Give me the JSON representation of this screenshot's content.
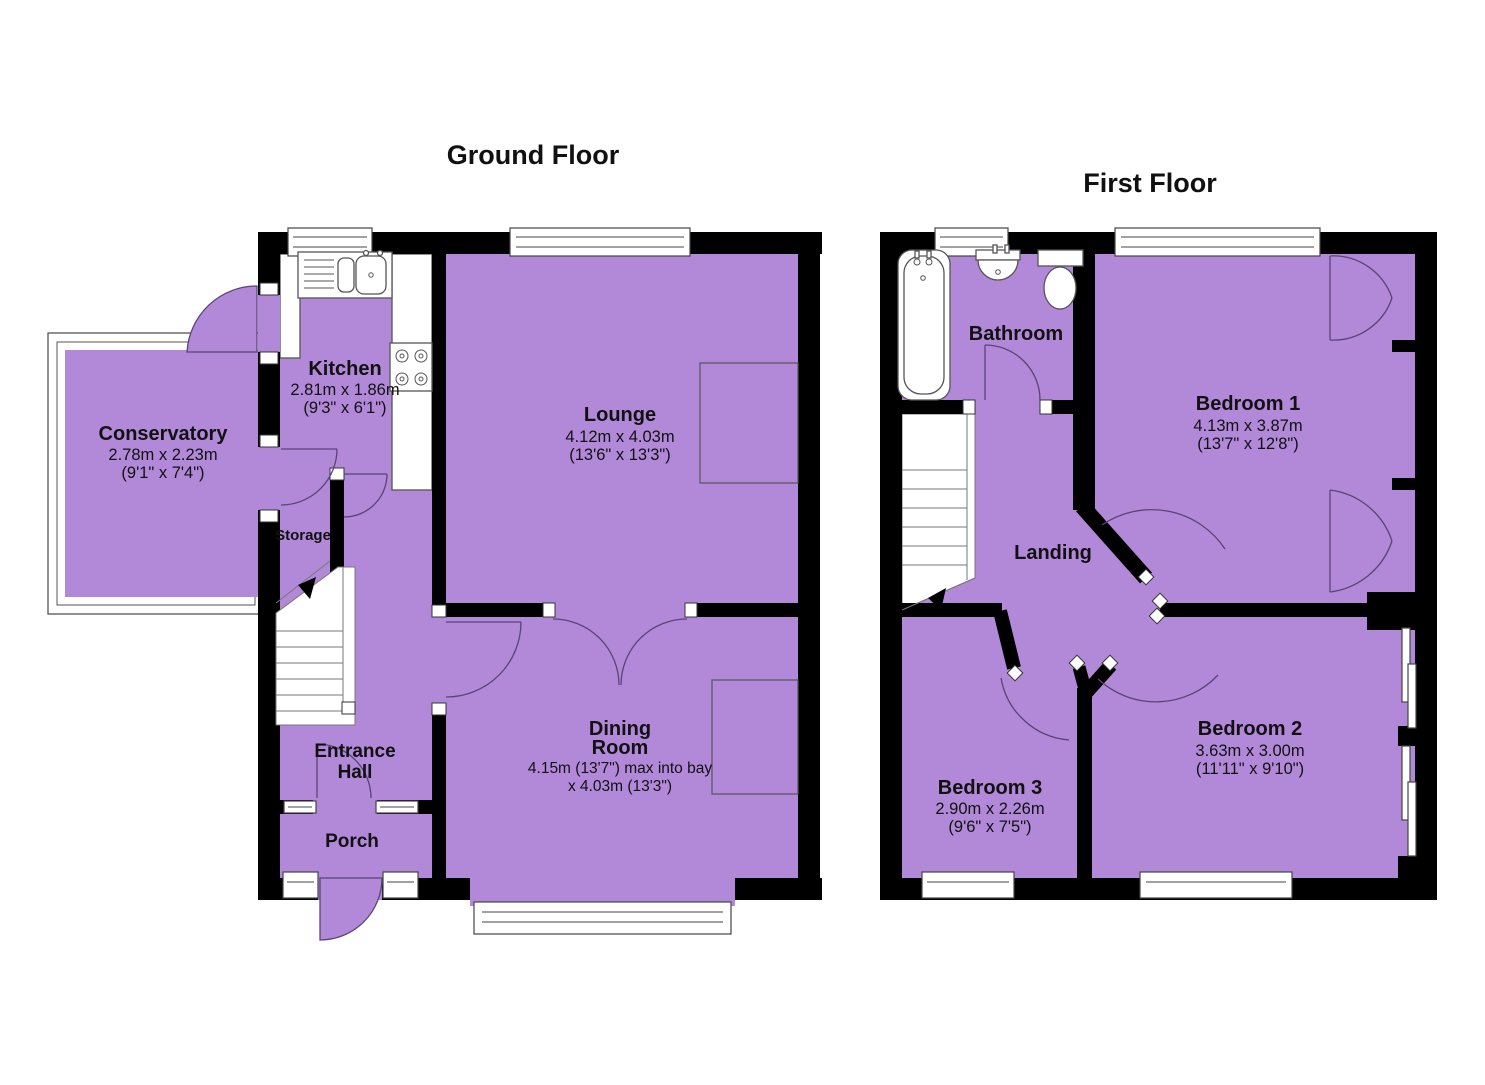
{
  "floors": [
    {
      "id": "ground-floor",
      "title": "Ground Floor",
      "rooms": [
        {
          "id": "kitchen",
          "name": "Kitchen",
          "dim_metric": "2.81m x 1.86m",
          "dim_imperial": "(9'3\" x 6'1\")"
        },
        {
          "id": "lounge",
          "name": "Lounge",
          "dim_metric": "4.12m x 4.03m",
          "dim_imperial": "(13'6\" x 13'3\")"
        },
        {
          "id": "conservatory",
          "name": "Conservatory",
          "dim_metric": "2.78m x 2.23m",
          "dim_imperial": "(9'1\" x 7'4\")"
        },
        {
          "id": "storage",
          "name": "Storage"
        },
        {
          "id": "entrance-hall",
          "line1": "Entrance",
          "line2": "Hall"
        },
        {
          "id": "porch",
          "name": "Porch"
        },
        {
          "id": "dining-room",
          "line1": "Dining",
          "line2": "Room",
          "dim_metric": "4.15m (13'7\") max into bay",
          "dim_imperial": "x 4.03m (13'3\")"
        }
      ]
    },
    {
      "id": "first-floor",
      "title": "First Floor",
      "rooms": [
        {
          "id": "bathroom",
          "name": "Bathroom"
        },
        {
          "id": "bedroom-1",
          "name": "Bedroom 1",
          "dim_metric": "4.13m x 3.87m",
          "dim_imperial": "(13'7\" x 12'8\")"
        },
        {
          "id": "landing",
          "name": "Landing"
        },
        {
          "id": "bedroom-3",
          "name": "Bedroom 3",
          "dim_metric": "2.90m x 2.26m",
          "dim_imperial": "(9'6\" x 7'5\")"
        },
        {
          "id": "bedroom-2",
          "name": "Bedroom 2",
          "dim_metric": "3.63m x 3.00m",
          "dim_imperial": "(11'11\" x 9'10\")"
        }
      ]
    }
  ],
  "colors": {
    "floor_fill": "#b289d8",
    "wall": "#000000",
    "fixture_stroke": "#555555",
    "door_arc": "#5a4377",
    "text": "#111111",
    "background": "#ffffff"
  }
}
